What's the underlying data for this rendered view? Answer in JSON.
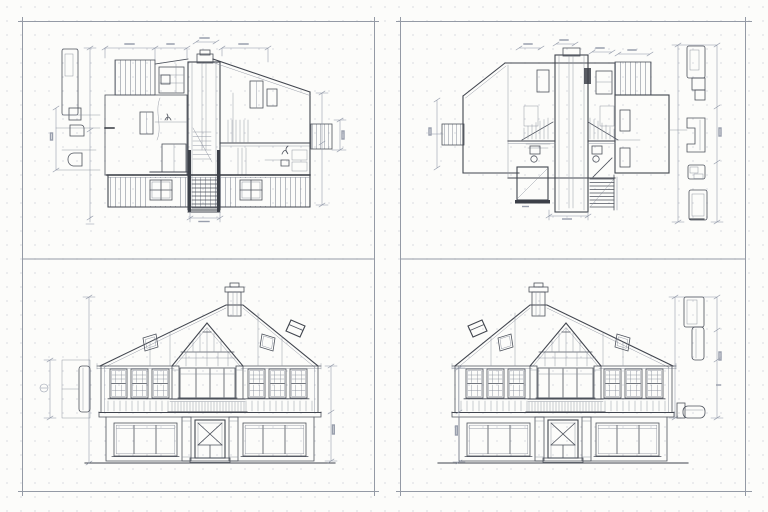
{
  "document": {
    "kind": "architectural working drawings, four framed sheets on one canvas",
    "legible_text": "none (all dimension annotations are sub-pixel illegible marks)"
  },
  "sheets": {
    "top_left": {
      "name": "section-a",
      "description": "Building cross-section: central stair/chimney shaft, left striped roof deck, right shed roof wing, board-sided basement with two cross windows, dimension strings and left-margin profile detail"
    },
    "top_right": {
      "name": "section-b",
      "description": "Mirrored building cross-section: central shaft with flanking stair railings, angled left wing with hatched porch, right rectangular wing, right-margin vertical detail strip with three profile blocks"
    },
    "bottom_left": {
      "name": "rear-elevation",
      "description": "House elevation: hipped roof with chimney right of center, two skylights per slope, glazed central gable over balcony, six gridded upper windows, lower level with wide windows and X-braced entry door, left profile detail and dimension lines"
    },
    "bottom_right": {
      "name": "front-elevation",
      "description": "Mirrored house elevation: hipped roof with chimney left of center, glazed central gable over balcony, six gridded upper windows, X-braced entry door, right-margin vertical section detail strip"
    }
  },
  "palette": {
    "paper": "#fcfcfa",
    "frame_line": "#949aa5",
    "drawing_line": "#4d525c",
    "bold_line": "#343840",
    "dimension_line": "#8d95a6",
    "hatch_line": "#7c828e",
    "dot_grid": "#dcdde2"
  }
}
